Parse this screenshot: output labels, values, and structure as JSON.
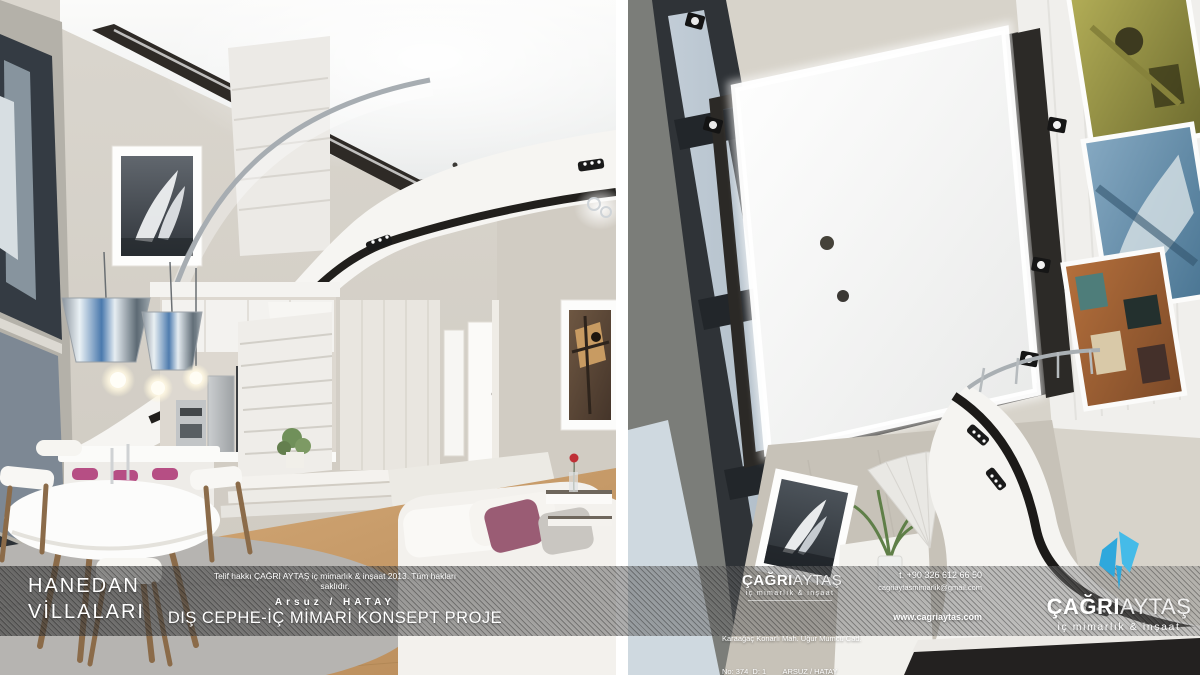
{
  "band": {
    "project_name_line1": "HANEDAN",
    "project_name_line2": "VİLLALARI",
    "copyright": "Telif hakkı  ÇAĞRI AYTAŞ iç mimarlık & inşaat 2013. Tüm hakları saklıdır.",
    "location": "Arsuz / HATAY",
    "subtitle": "DIŞ CEPHE-İÇ MİMARİ KONSEPT PROJE"
  },
  "brand": {
    "name_bold": "ÇAĞRI",
    "name_light": "AYTAŞ",
    "tagline": "iç mimarlık & inşaat",
    "logo_icon": "blue-shard-mark"
  },
  "contact": {
    "phone": "t. +90 326 612 66 50",
    "email": "cagriaytasmimarlik@gmail.com",
    "address_line1": "Karaağaç Konarlı Mah. Uğur Mumcu Cad.",
    "address_line2": "No: 374  D: 1        ARSUZ / HATAY",
    "website": "www.cagriaytas.com"
  },
  "colors": {
    "logo_blue": "#3cb4e5",
    "wall_beige": "#d6d2c9",
    "trim_dark": "#28251f",
    "wood_floor": "#c99f6e",
    "cushion_mauve": "#9a5c74",
    "band_overlay": "rgba(88,88,88,0.52)"
  }
}
